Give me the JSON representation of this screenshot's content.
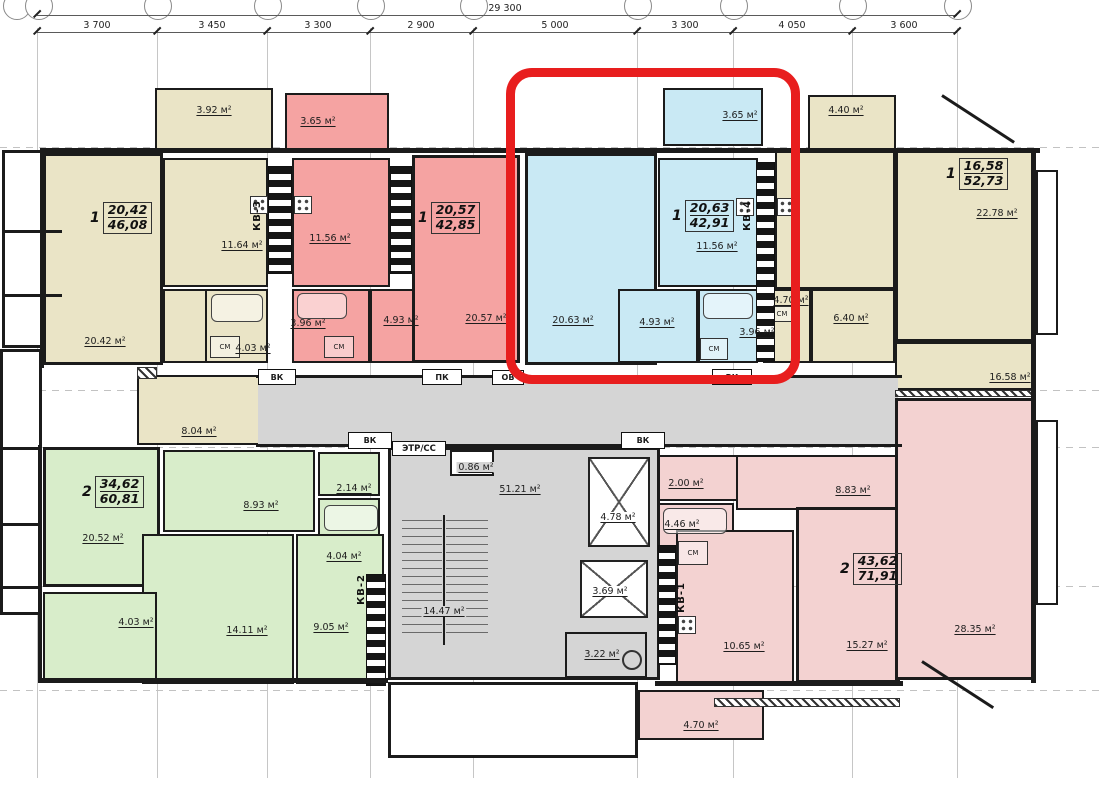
{
  "dimensions": {
    "total": "29 300",
    "segments": [
      "3 700",
      "3 450",
      "3 300",
      "2 900",
      "5 000",
      "3 300",
      "4 050",
      "3 600"
    ]
  },
  "shared": {
    "sm": "СМ",
    "vk": "ВК",
    "pk": "ПК",
    "ov": "ОВ",
    "panel": "ЭТР/СС",
    "panel_mark": "У"
  },
  "core": {
    "corridor": "51.21 м²",
    "vestibule": "0.86 м²",
    "elevator_large": "4.78 м²",
    "elevator_small": "3.69 м²",
    "utility": "3.22 м²",
    "stairwell": "14.47 м²"
  },
  "apartments": {
    "kv3": {
      "rooms": "1",
      "living": "20,42",
      "total": "46,08",
      "unit": "КВ-3",
      "room": "20.42 м²",
      "kitchen": "11.64 м²",
      "bath": "4.03 м²",
      "hall": "8.04 м²",
      "balcony": "3.92 м²"
    },
    "red": {
      "rooms": "1",
      "living": "20,57",
      "total": "42,85",
      "room": "20.57 м²",
      "kitchen": "11.56 м²",
      "bath": "3.96 м²",
      "hall": "4.93 м²",
      "balcony": "3.65 м²"
    },
    "kv4": {
      "rooms": "1",
      "living": "20,63",
      "total": "42,91",
      "unit": "КВ-4",
      "room": "20.63 м²",
      "kitchen": "11.56 м²",
      "bath": "3.96 м²",
      "hall": "4.93 м²",
      "balcony": "3.65 м²"
    },
    "right": {
      "rooms": "1",
      "living": "16,58",
      "total": "52,73",
      "room_large": "22.78 м²",
      "room": "16.58 м²",
      "bath": "4.70 м²",
      "hall": "6.40 м²",
      "balcony": "4.40 м²"
    },
    "kv2": {
      "rooms": "2",
      "living": "34,62",
      "total": "60,81",
      "unit": "КВ-2",
      "room1": "20.52 м²",
      "room2": "14.11 м²",
      "kitchen": "9.05 м²",
      "hall": "8.93 м²",
      "wc": "2.14 м²",
      "bath": "4.04 м²",
      "balcony": "4.03 м²"
    },
    "kv1": {
      "rooms": "2",
      "living": "43,62",
      "total": "71,91",
      "unit": "КВ-1",
      "room1": "28.35 м²",
      "room2": "15.27 м²",
      "kitchen": "10.65 м²",
      "hall": "8.83 м²",
      "wc": "2.00 м²",
      "bath": "4.46 м²",
      "balcony": "4.70 м²"
    }
  },
  "highlight": {
    "color": "#e81e1e"
  },
  "colors": {
    "beige": "#eae4c6",
    "salmon": "#f5a3a2",
    "blue": "#c9e9f4",
    "green": "#d8edca",
    "pink": "#f3d2d1",
    "gray": "#d5d5d5"
  }
}
